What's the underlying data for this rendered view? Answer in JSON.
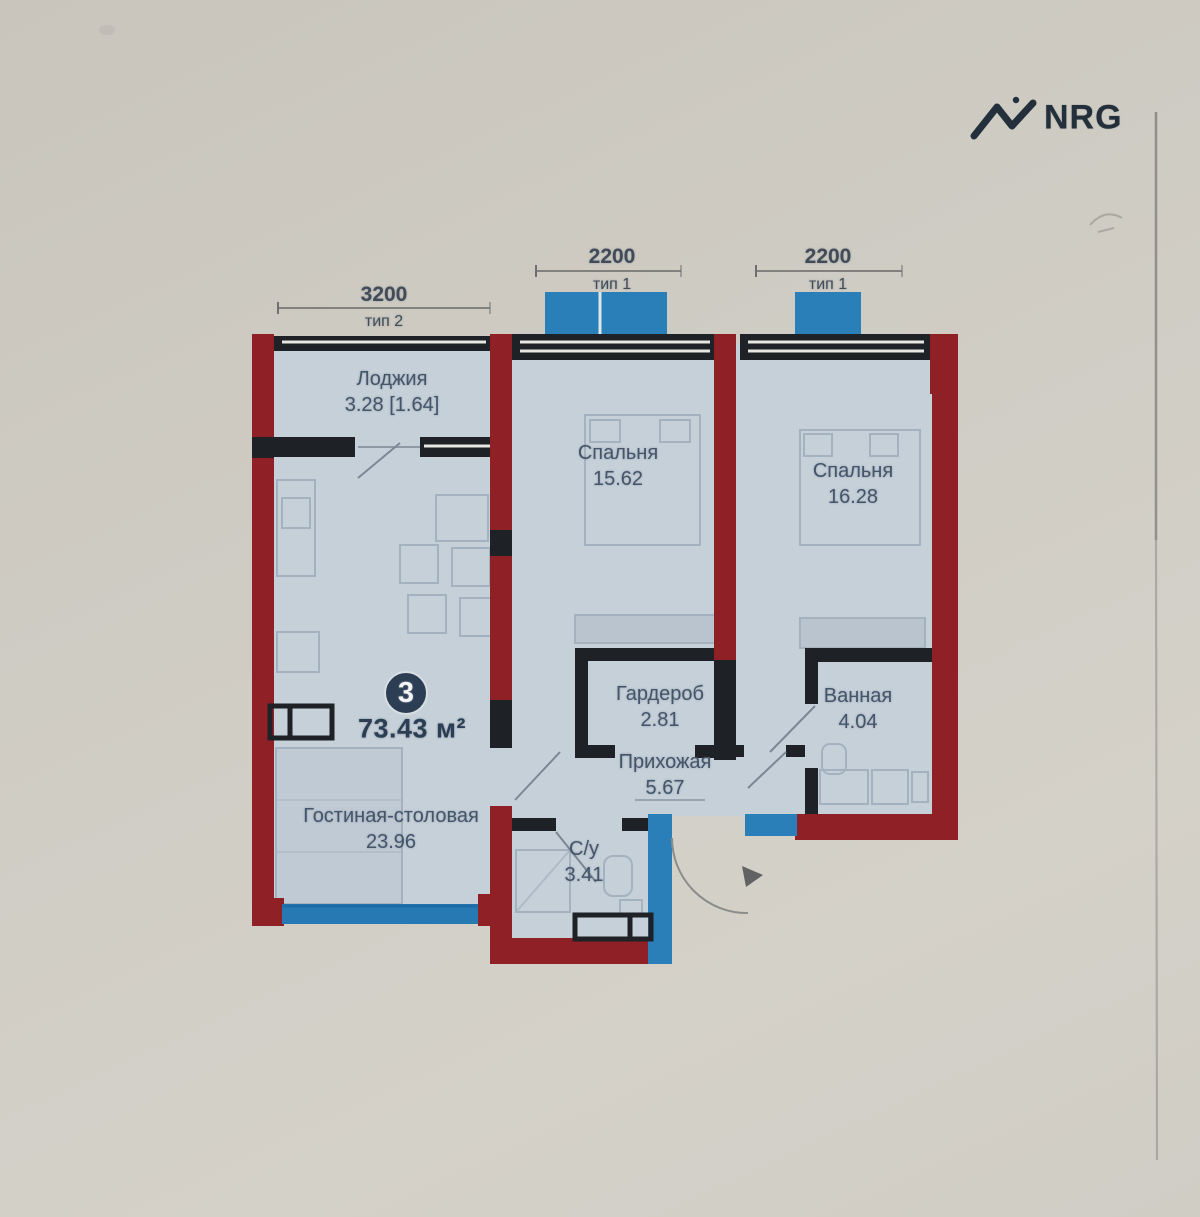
{
  "logo": {
    "brand": "NRG",
    "icon": "nrg-zigzag-icon"
  },
  "dimensions": [
    {
      "value": "3200",
      "type": "тип 2"
    },
    {
      "value": "2200",
      "type": "тип 1"
    },
    {
      "value": "2200",
      "type": "тип 1"
    }
  ],
  "badge": {
    "rooms_count": "3",
    "total_area": "73.43 м²"
  },
  "rooms": {
    "loggia": {
      "name": "Лоджия",
      "area": "3.28 [1.64]"
    },
    "bedroom1": {
      "name": "Спальня",
      "area": "15.62"
    },
    "bedroom2": {
      "name": "Спальня",
      "area": "16.28"
    },
    "wardrobe": {
      "name": "Гардероб",
      "area": "2.81"
    },
    "bathroom": {
      "name": "Ванная",
      "area": "4.04"
    },
    "hallway": {
      "name": "Прихожая",
      "area": "5.67"
    },
    "wc": {
      "name": "С/у",
      "area": "3.41"
    },
    "living": {
      "name": "Гостиная-столовая",
      "area": "23.96"
    }
  },
  "colors": {
    "paper": "#cdc9c1",
    "room_fill": "#c6d0d9",
    "wall_red": "#8f2026",
    "wall_black": "#1e2125",
    "window_blue": "#2a7fb8",
    "label_text": "#44556a",
    "brand_text": "#232f3a"
  }
}
